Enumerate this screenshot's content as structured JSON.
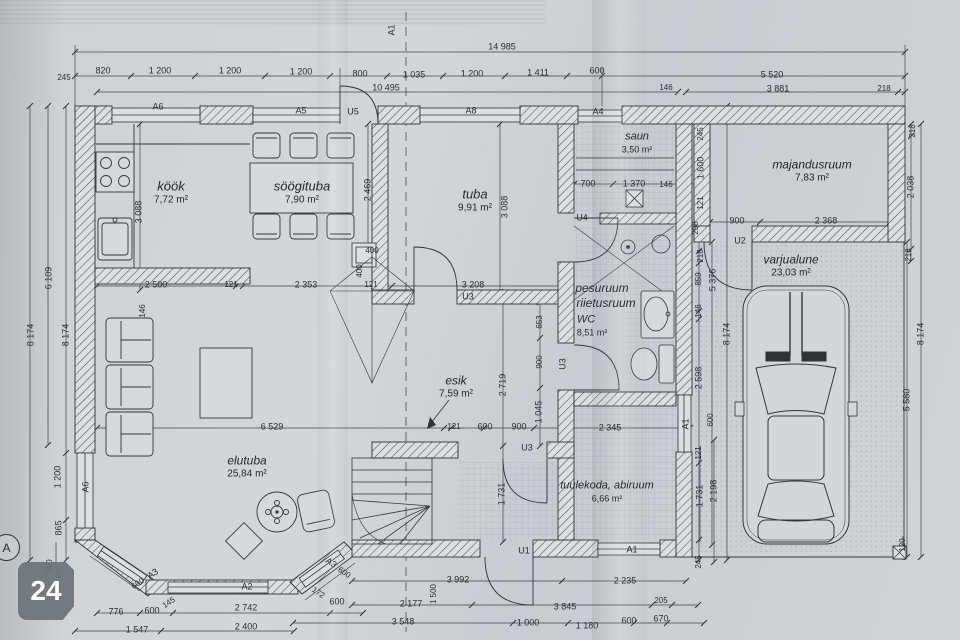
{
  "badge": {
    "number": "24"
  },
  "grid_marker": {
    "letter": "A"
  },
  "colors": {
    "paper": "#ced3d6",
    "line": "#2f3338",
    "wall_fill": "#dcdfe2",
    "badge_bg": "#6c7379",
    "badge_text": "#ffffff"
  },
  "rooms": [
    {
      "id": "kook",
      "name": "köök",
      "area": "7,72 m²",
      "x": 171,
      "y": 193,
      "ns": 13,
      "as": 10
    },
    {
      "id": "soogituba",
      "name": "söögituba",
      "area": "7,90 m²",
      "x": 302,
      "y": 193,
      "ns": 13,
      "as": 10
    },
    {
      "id": "tuba",
      "name": "tuba",
      "area": "9,91 m²",
      "x": 475,
      "y": 201,
      "ns": 13,
      "as": 10
    },
    {
      "id": "saun",
      "name": "saun",
      "area": "3,50 m²",
      "x": 637,
      "y": 143,
      "ns": 11,
      "as": 9
    },
    {
      "id": "majandusruum",
      "name": "majandusruum",
      "area": "7,83 m²",
      "x": 812,
      "y": 171,
      "ns": 12,
      "as": 10
    },
    {
      "id": "varjualune",
      "name": "varjualune",
      "area": "23,03 m²",
      "x": 791,
      "y": 266,
      "ns": 12,
      "as": 10
    },
    {
      "id": "esik",
      "name": "esik",
      "area": "7,59 m²",
      "x": 456,
      "y": 387,
      "ns": 12,
      "as": 10
    },
    {
      "id": "elutuba",
      "name": "elutuba",
      "area": "25,84 m²",
      "x": 247,
      "y": 467,
      "ns": 12,
      "as": 10
    },
    {
      "id": "tuulekoda",
      "name": "tuulekoda, abiruum",
      "area": "6,66 m²",
      "x": 607,
      "y": 492,
      "ns": 11,
      "as": 9
    }
  ],
  "labels": [
    {
      "t": "14 985",
      "x": 502,
      "y": 47
    },
    {
      "t": "820",
      "x": 103,
      "y": 71
    },
    {
      "t": "1 200",
      "x": 160,
      "y": 71
    },
    {
      "t": "1 200",
      "x": 230,
      "y": 71
    },
    {
      "t": "1 200",
      "x": 301,
      "y": 72
    },
    {
      "t": "800",
      "x": 360,
      "y": 74
    },
    {
      "t": "1 035",
      "x": 414,
      "y": 75
    },
    {
      "t": "1 200",
      "x": 472,
      "y": 74
    },
    {
      "t": "1 411",
      "x": 538,
      "y": 73
    },
    {
      "t": "600",
      "x": 597,
      "y": 71
    },
    {
      "t": "5 520",
      "x": 772,
      "y": 75
    },
    {
      "t": "245",
      "x": 64,
      "y": 78,
      "s": 8
    },
    {
      "t": "10 495",
      "x": 386,
      "y": 88
    },
    {
      "t": "146",
      "x": 666,
      "y": 88,
      "s": 8
    },
    {
      "t": "3 881",
      "x": 778,
      "y": 89
    },
    {
      "t": "218",
      "x": 884,
      "y": 89,
      "s": 8
    },
    {
      "t": "A6",
      "x": 158,
      "y": 107
    },
    {
      "t": "A5",
      "x": 301,
      "y": 111
    },
    {
      "t": "U5",
      "x": 353,
      "y": 112
    },
    {
      "t": "A8",
      "x": 471,
      "y": 111
    },
    {
      "t": "A4",
      "x": 598,
      "y": 112
    },
    {
      "t": "A1",
      "x": 392,
      "y": 30,
      "r": -90
    },
    {
      "t": "6 109",
      "x": 49,
      "y": 278,
      "r": -90
    },
    {
      "t": "8 174",
      "x": 31,
      "y": 335,
      "r": -90
    },
    {
      "t": "8 174",
      "x": 66,
      "y": 335,
      "r": -90
    },
    {
      "t": "1 200",
      "x": 58,
      "y": 477,
      "r": -90
    },
    {
      "t": "865",
      "x": 59,
      "y": 528,
      "r": -90
    },
    {
      "t": "600",
      "x": 50,
      "y": 566,
      "r": -90,
      "s": 8
    },
    {
      "t": "3 088",
      "x": 139,
      "y": 212,
      "r": -90
    },
    {
      "t": "146",
      "x": 143,
      "y": 311,
      "r": -90,
      "s": 8
    },
    {
      "t": "A6",
      "x": 86,
      "y": 487,
      "r": -90
    },
    {
      "t": "2 500",
      "x": 156,
      "y": 285
    },
    {
      "t": "121",
      "x": 231,
      "y": 285,
      "s": 8
    },
    {
      "t": "2 353",
      "x": 306,
      "y": 285
    },
    {
      "t": "2 469",
      "x": 368,
      "y": 190,
      "r": -90
    },
    {
      "t": "400",
      "x": 372,
      "y": 251,
      "s": 8
    },
    {
      "t": "400",
      "x": 360,
      "y": 271,
      "r": -90,
      "s": 8
    },
    {
      "t": "121",
      "x": 371,
      "y": 285,
      "s": 8
    },
    {
      "t": "3 088",
      "x": 505,
      "y": 207,
      "r": -90
    },
    {
      "t": "3 208",
      "x": 473,
      "y": 285
    },
    {
      "t": "U3",
      "x": 468,
      "y": 297
    },
    {
      "t": "6 529",
      "x": 272,
      "y": 427
    },
    {
      "t": "121",
      "x": 454,
      "y": 427,
      "s": 8
    },
    {
      "t": "600",
      "x": 485,
      "y": 427
    },
    {
      "t": "900",
      "x": 519,
      "y": 427
    },
    {
      "t": "2 345",
      "x": 610,
      "y": 428
    },
    {
      "t": "2 719",
      "x": 503,
      "y": 385,
      "r": -90
    },
    {
      "t": "653",
      "x": 540,
      "y": 322,
      "r": -90,
      "s": 8
    },
    {
      "t": "900",
      "x": 540,
      "y": 362,
      "r": -90,
      "s": 8
    },
    {
      "t": "1 045",
      "x": 539,
      "y": 412,
      "r": -90
    },
    {
      "t": "U3",
      "x": 527,
      "y": 448
    },
    {
      "t": "U3",
      "x": 563,
      "y": 364,
      "r": -90
    },
    {
      "t": "1 731",
      "x": 502,
      "y": 494,
      "r": -90
    },
    {
      "t": "U1",
      "x": 524,
      "y": 551
    },
    {
      "t": "A1",
      "x": 632,
      "y": 550
    },
    {
      "t": "A1",
      "x": 686,
      "y": 424,
      "r": -90
    },
    {
      "t": "700",
      "x": 588,
      "y": 184
    },
    {
      "t": "1 370",
      "x": 634,
      "y": 184
    },
    {
      "t": "146",
      "x": 666,
      "y": 185,
      "s": 8
    },
    {
      "t": "U4",
      "x": 582,
      "y": 218
    },
    {
      "t": "pesuruum",
      "x": 602,
      "y": 288,
      "s": 12,
      "i": 1
    },
    {
      "t": "riietusruum",
      "x": 606,
      "y": 303,
      "s": 12,
      "i": 1
    },
    {
      "t": "WC",
      "x": 586,
      "y": 320,
      "s": 11,
      "i": 1
    },
    {
      "t": "8,51 m²",
      "x": 592,
      "y": 333
    },
    {
      "t": "245",
      "x": 701,
      "y": 134,
      "r": -90,
      "s": 8
    },
    {
      "t": "1 600",
      "x": 701,
      "y": 168,
      "r": -90
    },
    {
      "t": "121",
      "x": 701,
      "y": 203,
      "r": -90,
      "s": 8
    },
    {
      "t": "298",
      "x": 696,
      "y": 228,
      "r": -90,
      "s": 8
    },
    {
      "t": "218",
      "x": 701,
      "y": 256,
      "r": -90,
      "s": 8
    },
    {
      "t": "859",
      "x": 699,
      "y": 279,
      "r": -90,
      "s": 8
    },
    {
      "t": "5 376",
      "x": 713,
      "y": 280,
      "r": -90
    },
    {
      "t": "146",
      "x": 699,
      "y": 311,
      "r": -90,
      "s": 8
    },
    {
      "t": "2 598",
      "x": 699,
      "y": 378,
      "r": -90
    },
    {
      "t": "600",
      "x": 711,
      "y": 420,
      "r": -90,
      "s": 8
    },
    {
      "t": "121",
      "x": 699,
      "y": 453,
      "r": -90,
      "s": 8
    },
    {
      "t": "1 731",
      "x": 700,
      "y": 496,
      "r": -90
    },
    {
      "t": "2 198",
      "x": 714,
      "y": 491,
      "r": -90
    },
    {
      "t": "245",
      "x": 699,
      "y": 562,
      "r": -90,
      "s": 8
    },
    {
      "t": "8 174",
      "x": 727,
      "y": 334,
      "r": -90
    },
    {
      "t": "U2",
      "x": 740,
      "y": 241
    },
    {
      "t": "900",
      "x": 737,
      "y": 221
    },
    {
      "t": "2 368",
      "x": 826,
      "y": 221
    },
    {
      "t": "218",
      "x": 913,
      "y": 131,
      "r": -90,
      "s": 8
    },
    {
      "t": "2 038",
      "x": 911,
      "y": 187,
      "r": -90
    },
    {
      "t": "218",
      "x": 909,
      "y": 255,
      "r": -90,
      "s": 8
    },
    {
      "t": "8 174",
      "x": 921,
      "y": 334,
      "r": -90
    },
    {
      "t": "5 580",
      "x": 907,
      "y": 400,
      "r": -90
    },
    {
      "t": "120",
      "x": 903,
      "y": 545,
      "r": -90,
      "s": 8
    },
    {
      "t": "A3",
      "x": 153,
      "y": 574,
      "r": -34
    },
    {
      "t": "600",
      "x": 138,
      "y": 584,
      "r": -34,
      "s": 8
    },
    {
      "t": "145",
      "x": 169,
      "y": 603,
      "r": -34,
      "s": 8
    },
    {
      "t": "A2",
      "x": 247,
      "y": 587
    },
    {
      "t": "A3",
      "x": 331,
      "y": 563,
      "r": 34
    },
    {
      "t": "600",
      "x": 344,
      "y": 573,
      "r": 34,
      "s": 8
    },
    {
      "t": "172",
      "x": 318,
      "y": 593,
      "r": 34,
      "s": 8
    },
    {
      "t": "776",
      "x": 116,
      "y": 612
    },
    {
      "t": "600",
      "x": 152,
      "y": 611
    },
    {
      "t": "2 742",
      "x": 246,
      "y": 608
    },
    {
      "t": "600",
      "x": 337,
      "y": 602
    },
    {
      "t": "1 547",
      "x": 137,
      "y": 630
    },
    {
      "t": "2 400",
      "x": 246,
      "y": 627
    },
    {
      "t": "3 992",
      "x": 458,
      "y": 580
    },
    {
      "t": "2 235",
      "x": 625,
      "y": 581
    },
    {
      "t": "2 177",
      "x": 411,
      "y": 604
    },
    {
      "t": "1 500",
      "x": 434,
      "y": 594,
      "r": -90,
      "s": 8
    },
    {
      "t": "3 845",
      "x": 565,
      "y": 607
    },
    {
      "t": "205",
      "x": 661,
      "y": 601,
      "s": 8
    },
    {
      "t": "3 548",
      "x": 403,
      "y": 622
    },
    {
      "t": "1 000",
      "x": 528,
      "y": 623
    },
    {
      "t": "1 180",
      "x": 587,
      "y": 626
    },
    {
      "t": "600",
      "x": 629,
      "y": 621
    },
    {
      "t": "670",
      "x": 661,
      "y": 619
    }
  ]
}
